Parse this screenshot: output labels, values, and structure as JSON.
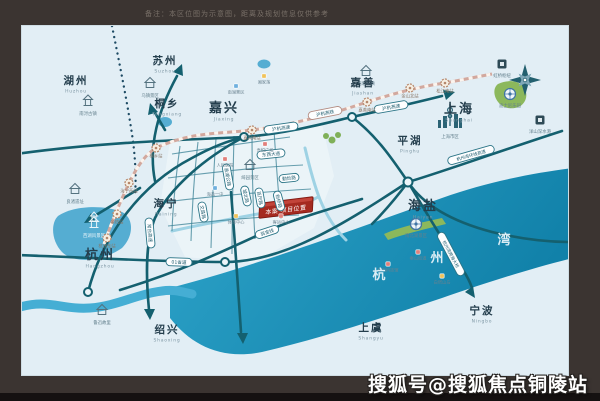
{
  "frame": {
    "caption": "备注：本区位图为示意图，距离及规划信息仅供参考",
    "watermark": "搜狐号@搜狐焦点铜陵站"
  },
  "colors": {
    "frame": "#3b3431",
    "map_bg": "#e2eef5",
    "bay": "#1a8db4",
    "road": "#14606f",
    "rail": "#d2a89e",
    "project_banner": "#a52a20"
  },
  "map": {
    "project": {
      "name": "本案·项目位置"
    },
    "bay_name": [
      {
        "ch": "杭",
        "x": 357,
        "y": 253
      },
      {
        "ch": "州",
        "x": 415,
        "y": 236
      },
      {
        "ch": "湾",
        "x": 482,
        "y": 218
      }
    ],
    "cities": [
      {
        "name": "湖州",
        "pinyin": "Huzhou",
        "x": 54,
        "y": 58,
        "major": false
      },
      {
        "name": "苏州",
        "pinyin": "Suzhou",
        "x": 143,
        "y": 38,
        "major": false
      },
      {
        "name": "桐乡",
        "pinyin": "Tongxiang",
        "x": 145,
        "y": 81,
        "major": false
      },
      {
        "name": "嘉兴",
        "pinyin": "Jiaxing",
        "x": 202,
        "y": 86,
        "major": true
      },
      {
        "name": "嘉善",
        "pinyin": "Jiashan",
        "x": 341,
        "y": 60,
        "major": false
      },
      {
        "name": "上海",
        "pinyin": "Shanghai",
        "x": 437,
        "y": 87,
        "major": true
      },
      {
        "name": "平湖",
        "pinyin": "Pinghu",
        "x": 388,
        "y": 118,
        "major": false
      },
      {
        "name": "海宁",
        "pinyin": "Haining",
        "x": 144,
        "y": 181,
        "major": false
      },
      {
        "name": "海盐",
        "pinyin": "Haiyan",
        "x": 401,
        "y": 184,
        "major": true
      },
      {
        "name": "杭州",
        "pinyin": "Hangzhou",
        "x": 78,
        "y": 233,
        "major": true
      },
      {
        "name": "绍兴",
        "pinyin": "Shaoxing",
        "x": 145,
        "y": 307,
        "major": false
      },
      {
        "name": "上虞",
        "pinyin": "Shangyu",
        "x": 349,
        "y": 305,
        "major": false
      },
      {
        "name": "宁波",
        "pinyin": "Ningbo",
        "x": 460,
        "y": 288,
        "major": false
      }
    ],
    "road_labels": [
      {
        "t": "沪杭高速",
        "x": 259,
        "y": 102,
        "r": -8,
        "w": 34,
        "rail": false
      },
      {
        "t": "沪杭高速",
        "x": 369,
        "y": 81,
        "r": -10,
        "w": 34,
        "rail": false
      },
      {
        "t": "沪杭高铁",
        "x": 303,
        "y": 87,
        "r": -11,
        "w": 34,
        "rail": true
      },
      {
        "t": "杭州湾环线高速",
        "x": 449,
        "y": 129,
        "r": -16,
        "w": 48,
        "rail": false
      },
      {
        "t": "杭州湾跨海大桥",
        "x": 429,
        "y": 228,
        "r": 62,
        "w": 48,
        "rail": false
      },
      {
        "t": "常台高速",
        "x": 128,
        "y": 207,
        "r": 85,
        "w": 30,
        "rail": false
      },
      {
        "t": "01省道",
        "x": 157,
        "y": 236,
        "r": 2,
        "w": 26,
        "rail": false
      },
      {
        "t": "翁金线",
        "x": 245,
        "y": 206,
        "r": -18,
        "w": 24,
        "rail": false
      },
      {
        "t": "东西大道",
        "x": 249,
        "y": 128,
        "r": -6,
        "w": 28,
        "rail": false
      },
      {
        "t": "勤俭路",
        "x": 267,
        "y": 152,
        "r": -6,
        "w": 20,
        "rail": false
      },
      {
        "t": "盐湖公路",
        "x": 206,
        "y": 151,
        "r": 80,
        "w": 26,
        "rail": false
      },
      {
        "t": "城北路",
        "x": 224,
        "y": 170,
        "r": 78,
        "w": 20,
        "rail": false
      },
      {
        "t": "百尺路",
        "x": 238,
        "y": 172,
        "r": 80,
        "w": 20,
        "rail": false
      },
      {
        "t": "新桥路",
        "x": 257,
        "y": 175,
        "r": 75,
        "w": 20,
        "rail": false
      },
      {
        "t": "文昌路",
        "x": 181,
        "y": 186,
        "r": 80,
        "w": 20,
        "rail": false
      }
    ],
    "stations": [
      {
        "name": "杭州东站",
        "x": 85,
        "y": 212
      },
      {
        "name": "余杭站",
        "x": 95,
        "y": 188
      },
      {
        "name": "海宁西站",
        "x": 107,
        "y": 157
      },
      {
        "name": "桐乡站",
        "x": 134,
        "y": 122
      },
      {
        "name": "嘉兴南站",
        "x": 230,
        "y": 104
      },
      {
        "name": "嘉善南站",
        "x": 345,
        "y": 76
      },
      {
        "name": "金山北站",
        "x": 388,
        "y": 62
      },
      {
        "name": "松江南站",
        "x": 423,
        "y": 57
      }
    ],
    "attractions": [
      {
        "t": "南浔古镇",
        "x": 66,
        "y": 76,
        "icon": "pagoda",
        "light": false
      },
      {
        "t": "乌镇景区",
        "x": 128,
        "y": 58,
        "icon": "house",
        "light": false
      },
      {
        "t": "西塘古镇",
        "x": 344,
        "y": 46,
        "icon": "house",
        "light": false
      },
      {
        "t": "良渚遗址",
        "x": 53,
        "y": 164,
        "icon": "house",
        "light": false
      },
      {
        "t": "西湖风景区",
        "x": 72,
        "y": 198,
        "icon": "pagoda",
        "light": true
      },
      {
        "t": "鲁迅故里",
        "x": 80,
        "y": 285,
        "icon": "house",
        "light": false
      },
      {
        "t": "迪士尼乐园",
        "x": 488,
        "y": 68,
        "icon": "badge",
        "light": false
      },
      {
        "t": "南北湖景区",
        "x": 394,
        "y": 198,
        "icon": "badge",
        "light": false
      },
      {
        "t": "绮园景区",
        "x": 228,
        "y": 140,
        "icon": "house",
        "light": false
      },
      {
        "t": "虹桥枢纽",
        "x": 480,
        "y": 38,
        "icon": "square",
        "light": false
      },
      {
        "t": "洋山深水港",
        "x": 518,
        "y": 94,
        "icon": "square",
        "light": false
      },
      {
        "t": "上海市区",
        "x": 428,
        "y": 99,
        "icon": "skyline",
        "light": false
      }
    ],
    "pois": [
      {
        "t": "南湖景区",
        "x": 214,
        "y": 60,
        "c": "#6fb0de"
      },
      {
        "t": "湘家荡",
        "x": 242,
        "y": 50,
        "c": "#f0c35b"
      },
      {
        "t": "吾悦广场",
        "x": 243,
        "y": 118,
        "c": "#e2807b"
      },
      {
        "t": "人民医院",
        "x": 203,
        "y": 133,
        "c": "#e2807b"
      },
      {
        "t": "海盐一中",
        "x": 193,
        "y": 162,
        "c": "#6fb0de"
      },
      {
        "t": "体育中心",
        "x": 214,
        "y": 190,
        "c": "#f0c35b"
      },
      {
        "t": "客运中心",
        "x": 259,
        "y": 190,
        "c": "#e2807b"
      },
      {
        "t": "核电科技馆",
        "x": 366,
        "y": 238,
        "c": "#e2807b"
      },
      {
        "t": "秦山街道",
        "x": 396,
        "y": 226,
        "c": "#e2807b"
      },
      {
        "t": "白塔山岛",
        "x": 420,
        "y": 250,
        "c": "#f0c35b"
      }
    ]
  }
}
